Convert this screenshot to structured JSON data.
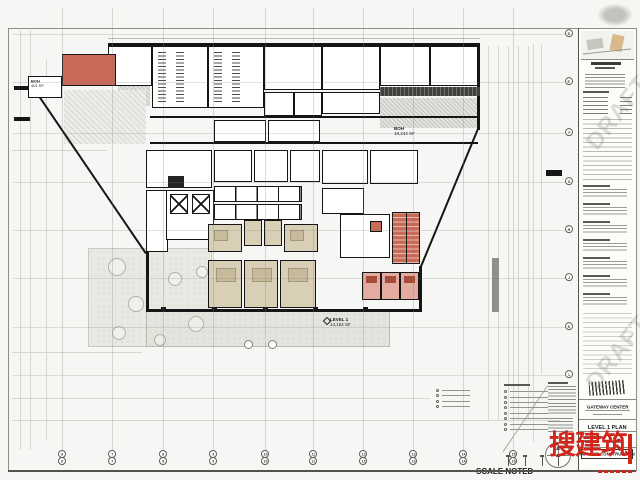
{
  "colors": {
    "logo-red": "#d2251c",
    "room-red": "#c96a57",
    "room-beige": "#d8cfb6",
    "room-pink": "#e4aba0"
  },
  "grid": {
    "cols": [
      {
        "label": "6",
        "x": 62
      },
      {
        "label": "7",
        "x": 112
      },
      {
        "label": "8",
        "x": 163
      },
      {
        "label": "9",
        "x": 213
      },
      {
        "label": "10",
        "x": 265
      },
      {
        "label": "11",
        "x": 313
      },
      {
        "label": "12",
        "x": 363
      },
      {
        "label": "13",
        "x": 413
      },
      {
        "label": "14",
        "x": 463
      },
      {
        "label": "15",
        "x": 513
      }
    ],
    "rows": [
      {
        "label": "D",
        "y": 34
      },
      {
        "label": "E",
        "y": 82
      },
      {
        "label": "F",
        "y": 133
      },
      {
        "label": "G",
        "y": 182
      },
      {
        "label": "H",
        "y": 230
      },
      {
        "label": "J",
        "y": 278
      },
      {
        "label": "K",
        "y": 327
      },
      {
        "label": "L",
        "y": 375
      }
    ]
  },
  "plan": {
    "level_marker": {
      "label": "LEVEL 1",
      "area": "14,164 SF"
    },
    "boh_right": {
      "label": "BOH",
      "area": "18,243 SF"
    },
    "boh_left": {
      "label": "BOH",
      "area": "401 SF"
    }
  },
  "titleblock": {
    "watermark": "DRAFT",
    "project_name": "GATEWAY CENTER",
    "sheet_title": "LEVEL 1 PLAN",
    "sheet_number": "A101",
    "stamp_text": "NOT FOR CONSTRUCTION"
  },
  "footer": {
    "scale_note": "SCALE NOTED"
  },
  "logo": {
    "text": "搜建筑"
  }
}
